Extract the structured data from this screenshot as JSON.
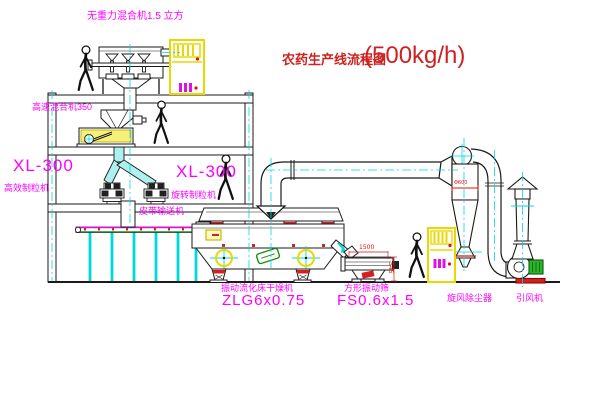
{
  "title": {
    "name_cn": "农药生产线流程图",
    "capacity": "(500kg/h)"
  },
  "labels": {
    "gravity_free_mixer": "无重力混合机1.5 立方",
    "high_speed_mixer": "高速混合机350",
    "granulator_left_model": "XL-300",
    "granulator_left_type": "高效制粒机",
    "granulator_center_model": "XL-300",
    "granulator_center_type": "旋转制粒机",
    "belt_conveyor": "皮带输送机",
    "fluid_bed_dryer_type": "振动流化床干燥机",
    "fluid_bed_dryer_model": "ZLG6x0.75",
    "square_sieve_type": "方形振动筛",
    "square_sieve_model": "FS0.6x1.5",
    "cyclone_collector": "旋风除尘器",
    "induced_draft_fan": "引风机"
  },
  "dimensions": {
    "sieve_length": "1500",
    "sieve_height": "545",
    "cyclone_dia": "Φ600"
  },
  "colors": {
    "label_magenta": "#ff00ff",
    "title_red": "#cc2222",
    "dimension_red": "#e01010",
    "centerline_cyan": "#00d9d9",
    "cabinet_yellow": "#e8d800",
    "motor_green": "#2ab52a",
    "base_red": "#d42020"
  }
}
